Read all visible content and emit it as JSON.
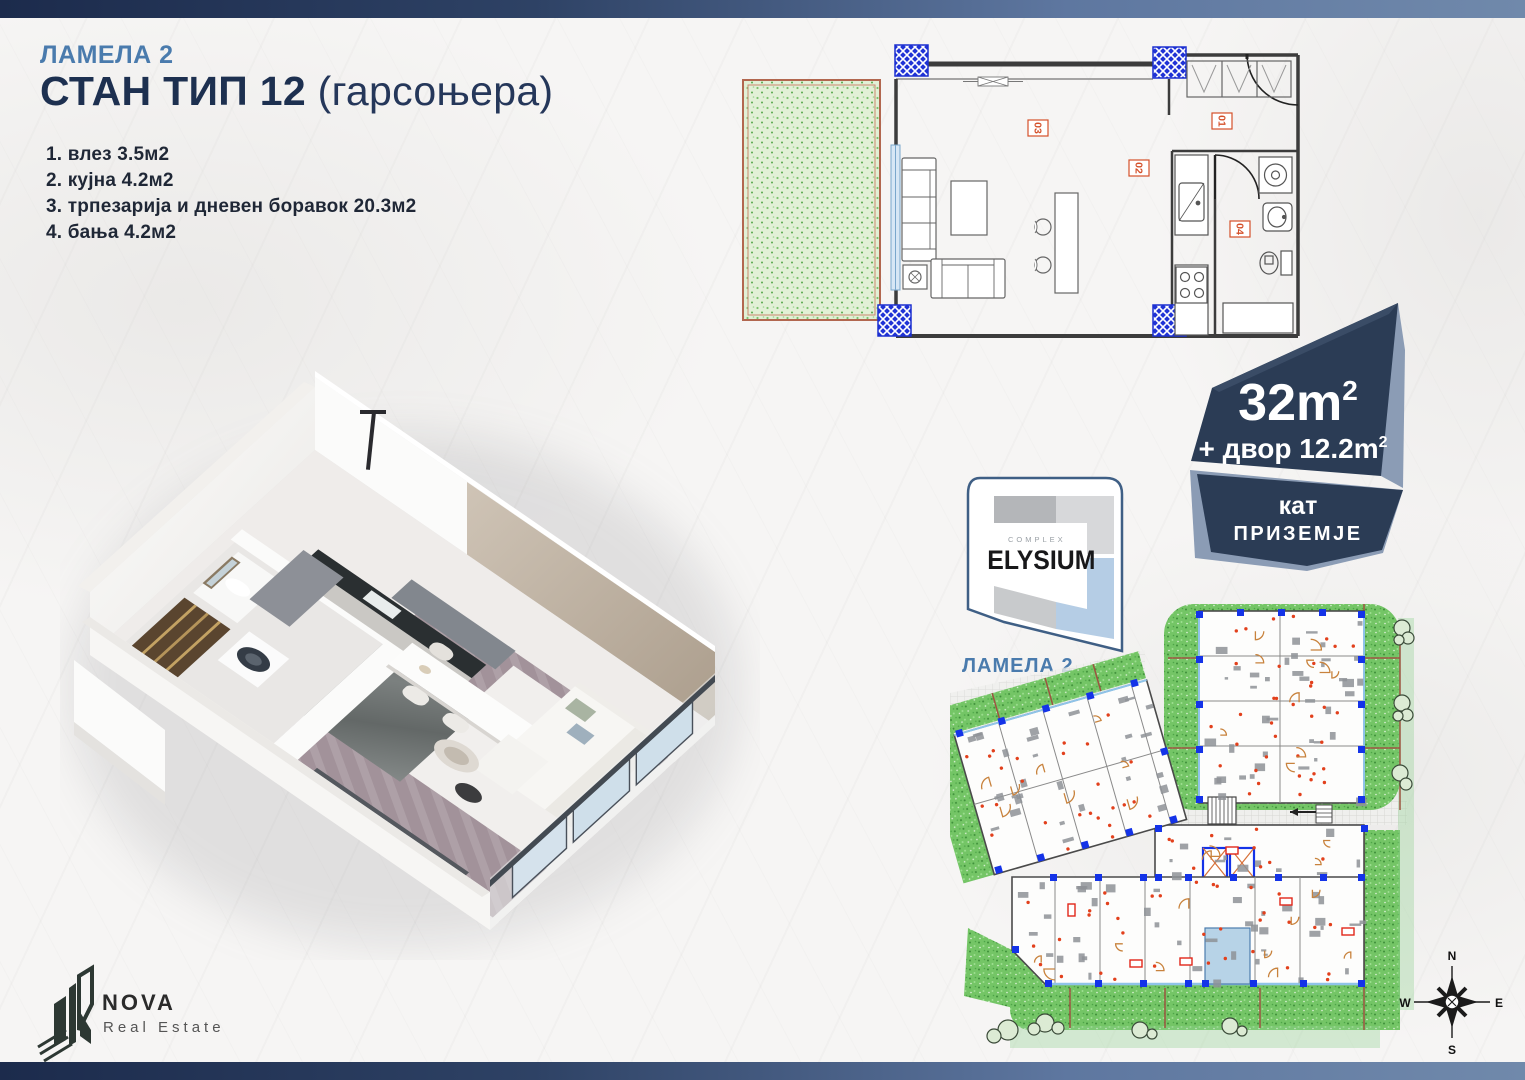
{
  "header": {
    "lamela": "ЛАМЕЛА 2",
    "title": "СТАН ТИП 12",
    "title_suffix": " (гарсоњера)"
  },
  "rooms": [
    "1. влез 3.5м2",
    "2. кујна 4.2м2",
    "3. трпезарија и дневен боравок 20.3м2",
    "4. бања 4.2м2"
  ],
  "plan2d": {
    "room_labels": [
      "03",
      "01",
      "02",
      "04"
    ]
  },
  "badge": {
    "area": "32m",
    "area_sup": "2",
    "yard": "+ двор 12.2m",
    "yard_sup": "2",
    "floor_word": "кат",
    "floor_value": "ПРИЗЕМЈЕ"
  },
  "elysium": {
    "complex_label": "COMPLEX",
    "brand": "ELYSIUM"
  },
  "siteplan": {
    "lamela_label": "ЛАМЕЛА 2",
    "compass": {
      "n": "N",
      "e": "E",
      "s": "S",
      "w": "W"
    }
  },
  "nova": {
    "brand": "NOVA",
    "subtitle": "Real Estate"
  },
  "colors": {
    "accent_blue": "#4a7bad",
    "navy": "#1d3050",
    "badge_navy": "#2b3c55",
    "badge_facet": "#8b9cb5",
    "column_blue": "#1d33d8",
    "label_red": "#d4502a",
    "yard_green": "#dff0d2",
    "site_green": "#5fbb5f"
  }
}
